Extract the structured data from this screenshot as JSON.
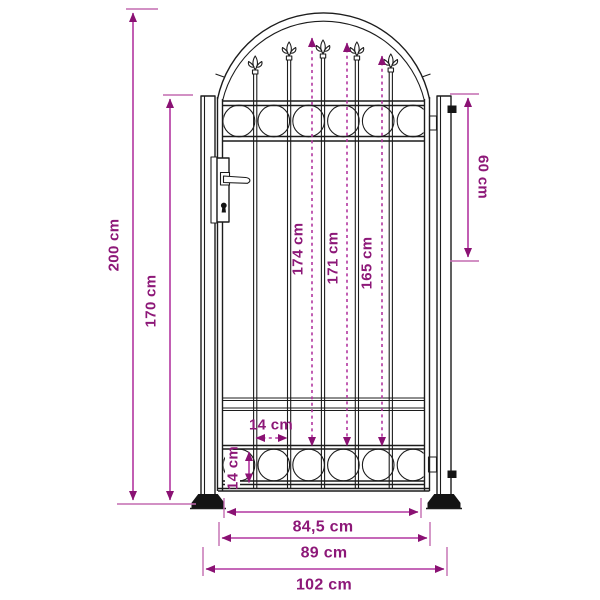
{
  "diagram": {
    "type": "product-dimension-diagram",
    "subject": "arched garden fence gate with spear finials, circle ornament bands, lock and two posts",
    "unit": "cm",
    "colors": {
      "dimension_line": "#b236a0",
      "arrowhead": "#8a1173",
      "label_text": "#8d1878",
      "line_art": "#1c1c1c",
      "background": "#ffffff"
    },
    "labels": {
      "total_height": "200 cm",
      "frame_height": "170 cm",
      "hinge_distance": "60 cm",
      "bar_height_center": "174 cm",
      "bar_height_inner": "171 cm",
      "bar_height_outer": "165 cm",
      "bar_spacing": "14 cm",
      "ornament_band_height": "14 cm",
      "leaf_width": "84,5 cm",
      "frame_width": "89 cm",
      "total_width": "102 cm"
    }
  }
}
